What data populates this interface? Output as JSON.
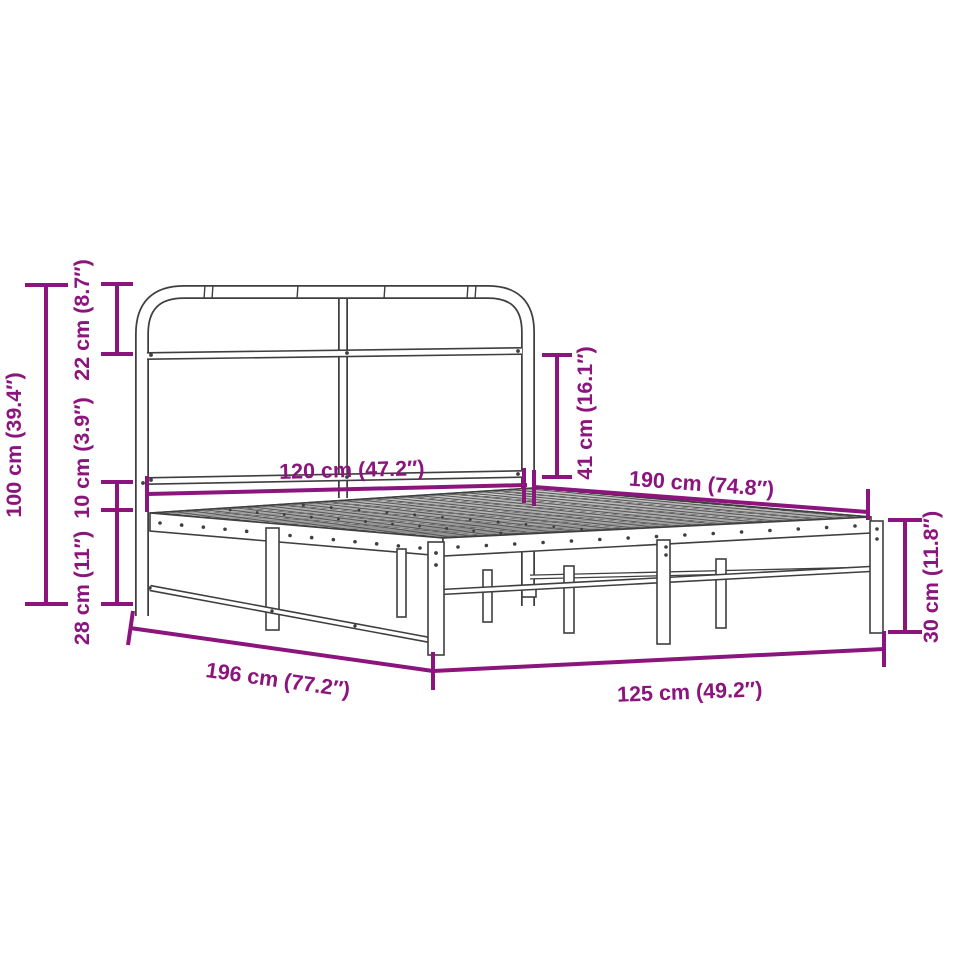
{
  "diagram": {
    "type": "product-dimension-diagram",
    "product": "metal-bed-frame-with-headboard",
    "background_color": "#ffffff",
    "dimension_color": "#8c147d",
    "frame_color": "#3f3f3f",
    "dimensions": {
      "total_height": {
        "label": "100 cm (39.4″)",
        "cm": 100,
        "inches": 39.4
      },
      "headboard_top_section": {
        "label": "22 cm (8.7″)",
        "cm": 22,
        "inches": 8.7
      },
      "headboard_gap": {
        "label": "10 cm (3.9″)",
        "cm": 10,
        "inches": 3.9
      },
      "under_bed_clearance": {
        "label": "28 cm (11″)",
        "cm": 28,
        "inches": 11
      },
      "headboard_width": {
        "label": "120 cm (47.2″)",
        "cm": 120,
        "inches": 47.2
      },
      "sleeping_length": {
        "label": "190 cm (74.8″)",
        "cm": 190,
        "inches": 74.8
      },
      "headboard_panel_height": {
        "label": "41 cm (16.1″)",
        "cm": 41,
        "inches": 16.1
      },
      "side_frame_height": {
        "label": "30 cm (11.8″)",
        "cm": 30,
        "inches": 11.8
      },
      "total_length": {
        "label": "196 cm (77.2″)",
        "cm": 196,
        "inches": 77.2
      },
      "total_width": {
        "label": "125 cm (49.2″)",
        "cm": 125,
        "inches": 49.2
      }
    }
  }
}
